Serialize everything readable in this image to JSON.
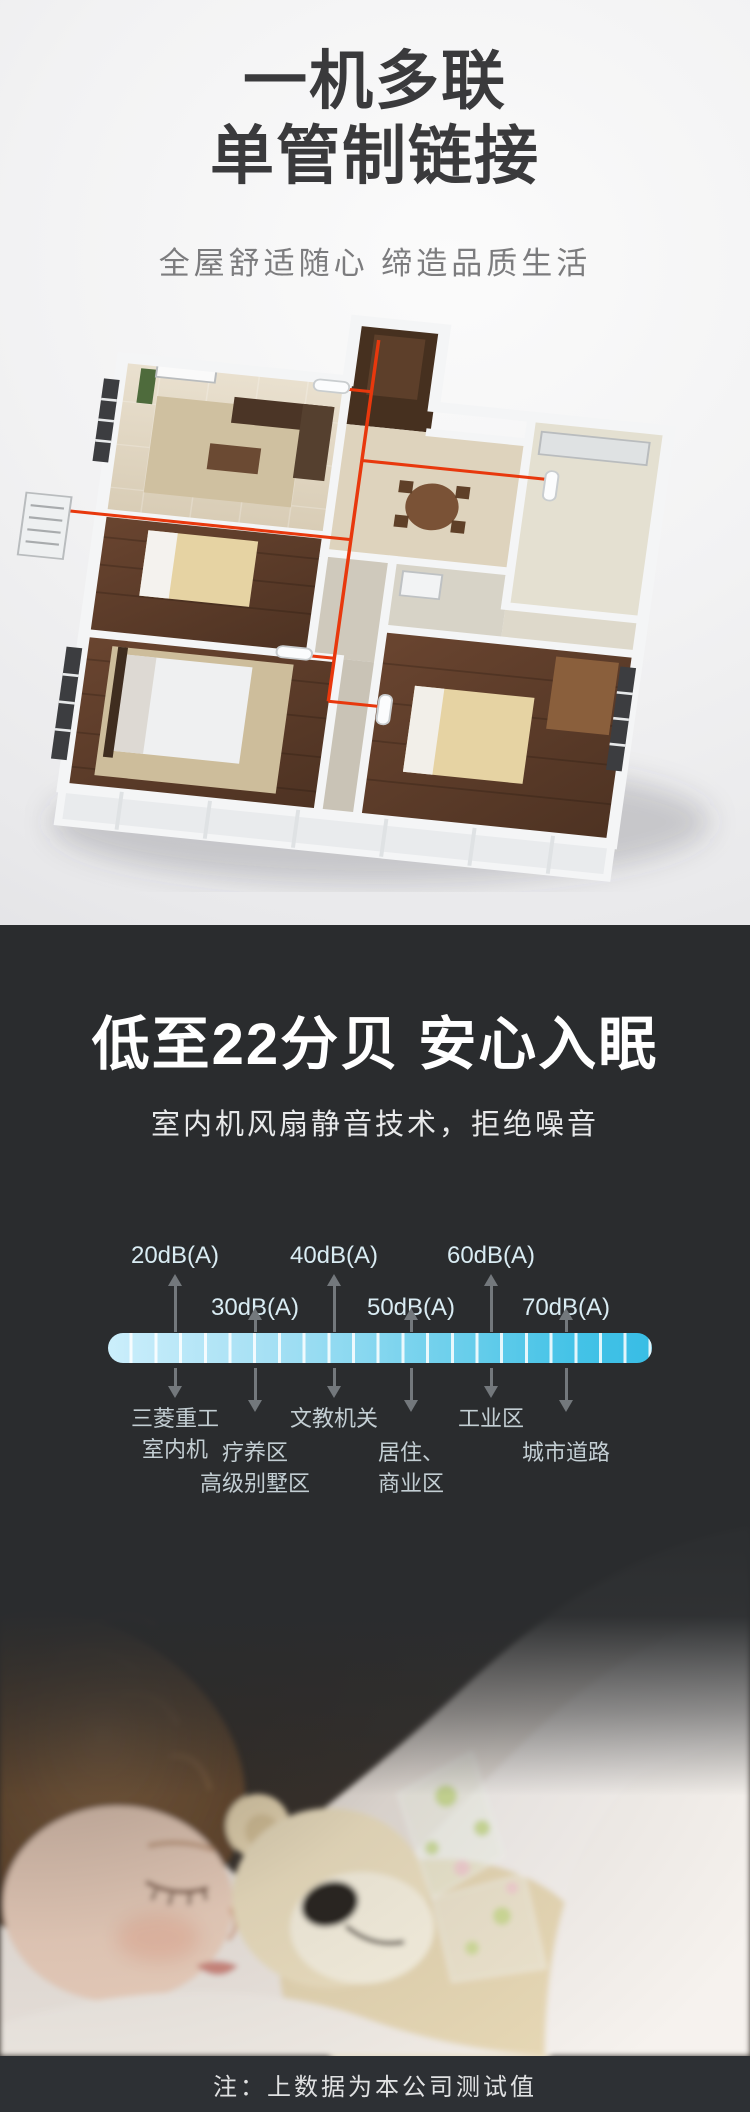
{
  "hero": {
    "title_line1": "一机多联",
    "title_line2": "单管制链接",
    "subtitle": "全屋舒适随心  缔造品质生活"
  },
  "noise": {
    "title": "低至22分贝 安心入眠",
    "subtitle": "室内机风扇静音技术，拒绝噪音",
    "footnote": "注：上数据为本公司测试值"
  },
  "chart_data": {
    "type": "scale",
    "title": "",
    "unit": "dB(A)",
    "axis_min": 20,
    "axis_max": 70,
    "highlight_value": "22分贝",
    "legend_position": "none",
    "columns": [
      {
        "tick": "20dB(A)",
        "value": 20,
        "tick_row": "upper",
        "label_line1": "三菱重工",
        "label_line2": "室内机"
      },
      {
        "tick": "30dB(A)",
        "value": 30,
        "tick_row": "lower",
        "label_line1": "疗养区",
        "label_line2": "高级别墅区"
      },
      {
        "tick": "40dB(A)",
        "value": 40,
        "tick_row": "upper",
        "label_line1": "文教机关",
        "label_line2": ""
      },
      {
        "tick": "50dB(A)",
        "value": 50,
        "tick_row": "lower",
        "label_line1": "居住、",
        "label_line2": "商业区"
      },
      {
        "tick": "60dB(A)",
        "value": 60,
        "tick_row": "upper",
        "label_line1": "工业区",
        "label_line2": ""
      },
      {
        "tick": "70dB(A)",
        "value": 70,
        "tick_row": "lower",
        "label_line1": "城市道路",
        "label_line2": ""
      }
    ]
  },
  "colors": {
    "hero_background": "#f1f1f2",
    "hero_title": "#3a3a3c",
    "hero_subtitle": "#7c7c7e",
    "dark_background": "#2a2c2e",
    "scale_bar_start": "#cbeefb",
    "scale_bar_end": "#38bde5",
    "tick_label": "#d9ecf3",
    "category_label": "#c3ced3",
    "arrow": "#73787c",
    "refrigerant_pipe_red": "#e8380d",
    "footnote_bar_background": "#2d3034"
  }
}
